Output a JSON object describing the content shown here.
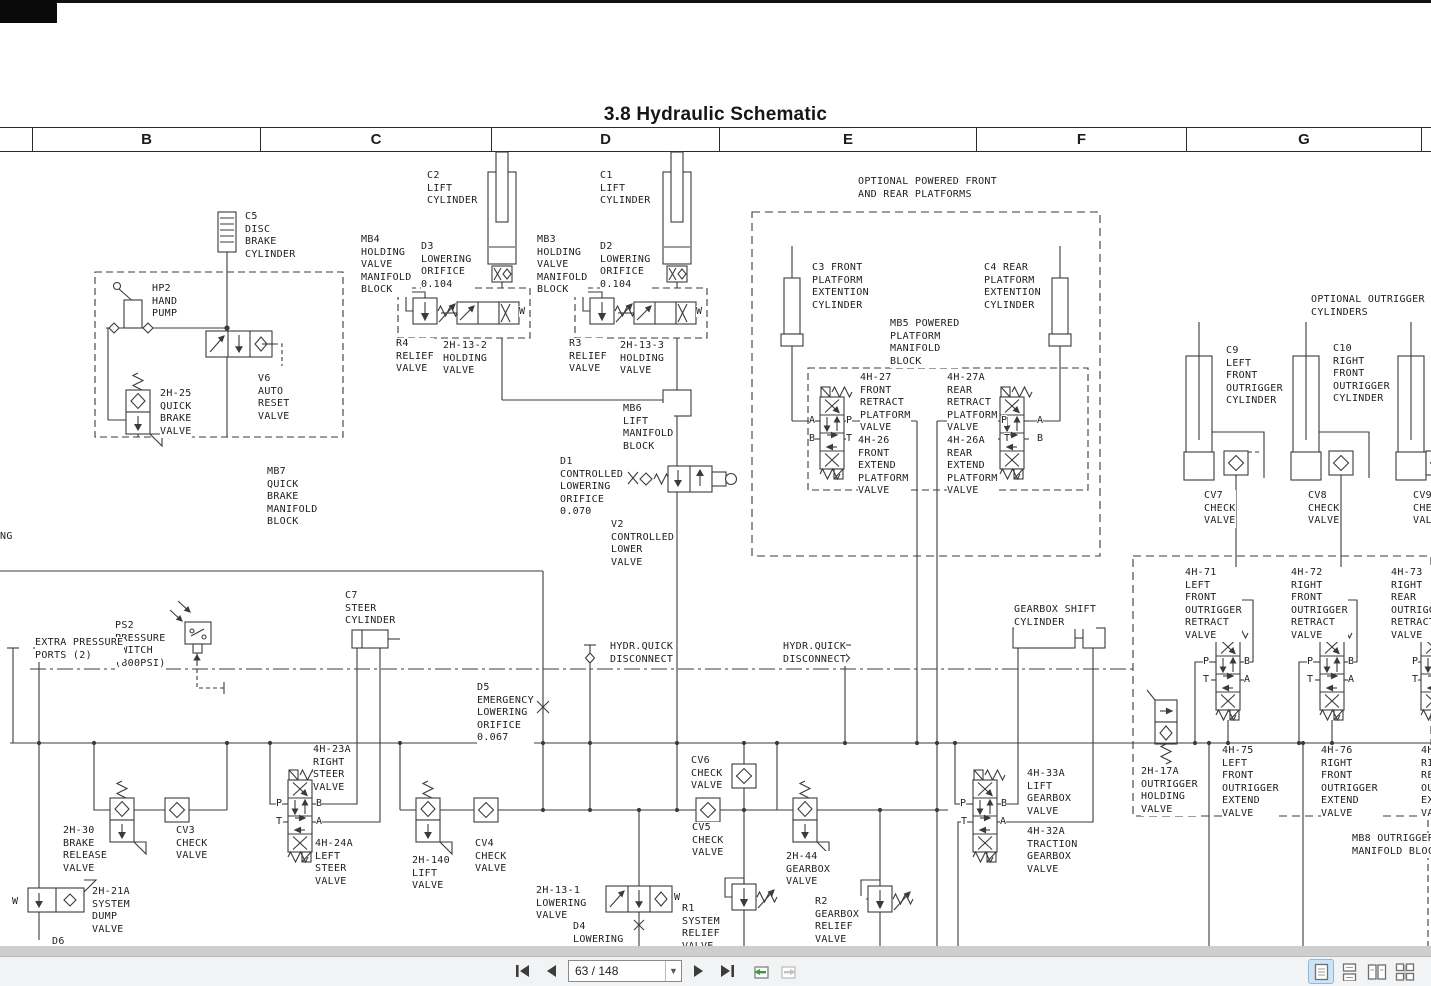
{
  "document": {
    "title": "3.8  Hydraulic Schematic",
    "grid_columns": [
      "B",
      "C",
      "D",
      "E",
      "F",
      "G"
    ],
    "page_number_shown": "63",
    "page_count_shown": "148",
    "schematic": {
      "line_color": "#3b3b3b",
      "labels": [
        {
          "text": "C5\nDISC\nBRAKE\nCYLINDER",
          "x": 245,
          "y": 211
        },
        {
          "text": "C2\nLIFT\nCYLINDER",
          "x": 427,
          "y": 170
        },
        {
          "text": "C1\nLIFT\nCYLINDER",
          "x": 600,
          "y": 170
        },
        {
          "text": "OPTIONAL POWERED FRONT\nAND REAR PLATFORMS",
          "x": 858,
          "y": 176
        },
        {
          "text": "MB4\nHOLDING\nVALVE\nMANIFOLD\nBLOCK",
          "x": 361,
          "y": 234
        },
        {
          "text": "D3\nLOWERING\nORIFICE\n0.104",
          "x": 421,
          "y": 241
        },
        {
          "text": "MB3\nHOLDING\nVALVE\nMANIFOLD\nBLOCK",
          "x": 537,
          "y": 234
        },
        {
          "text": "D2\nLOWERING\nORIFICE\n0.104",
          "x": 600,
          "y": 241
        },
        {
          "text": "HP2\nHAND\nPUMP",
          "x": 152,
          "y": 283
        },
        {
          "text": "OPTIONAL OUTRIGGER\nCYLINDERS",
          "x": 1311,
          "y": 294
        },
        {
          "text": "C3 FRONT\nPLATFORM\nEXTENTION\nCYLINDER",
          "x": 812,
          "y": 262
        },
        {
          "text": "C4 REAR\nPLATFORM\nEXTENTION\nCYLINDER",
          "x": 984,
          "y": 262
        },
        {
          "text": "MB5 POWERED\nPLATFORM\nMANIFOLD\nBLOCK",
          "x": 890,
          "y": 318
        },
        {
          "text": "R4\nRELIEF\nVALVE",
          "x": 396,
          "y": 338
        },
        {
          "text": "2H-13-2\nHOLDING\nVALVE",
          "x": 443,
          "y": 340
        },
        {
          "text": "R3\nRELIEF\nVALVE",
          "x": 569,
          "y": 338
        },
        {
          "text": "2H-13-3\nHOLDING\nVALVE",
          "x": 620,
          "y": 340
        },
        {
          "text": "C9\nLEFT\nFRONT\nOUTRIGGER\nCYLINDER",
          "x": 1226,
          "y": 345
        },
        {
          "text": "C10\nRIGHT\nFRONT\nOUTRIGGER\nCYLINDER",
          "x": 1333,
          "y": 343
        },
        {
          "text": "V6\nAUTO\nRESET\nVALVE",
          "x": 258,
          "y": 373
        },
        {
          "text": "2H-25\nQUICK\nBRAKE\nVALVE",
          "x": 160,
          "y": 388
        },
        {
          "text": "4H-27\nFRONT\nRETRACT\nPLATFORM\nVALVE",
          "x": 860,
          "y": 372
        },
        {
          "text": "4H-27A\nREAR\nRETRACT\nPLATFORM\nVALVE",
          "x": 947,
          "y": 372
        },
        {
          "text": "MB6\nLIFT\nMANIFOLD\nBLOCK",
          "x": 623,
          "y": 403
        },
        {
          "text": "4H-26\nFRONT\nEXTEND\nPLATFORM\nVALVE",
          "x": 858,
          "y": 435
        },
        {
          "text": "4H-26A\nREAR\nEXTEND\nPLATFORM\nVALVE",
          "x": 947,
          "y": 435
        },
        {
          "text": "D1\nCONTROLLED\nLOWERING\nORIFICE\n0.070",
          "x": 560,
          "y": 456
        },
        {
          "text": "MB7\nQUICK\nBRAKE\nMANIFOLD\nBLOCK",
          "x": 267,
          "y": 466
        },
        {
          "text": "CV7\nCHECK\nVALVE",
          "x": 1204,
          "y": 490
        },
        {
          "text": "CV8\nCHECK\nVALVE",
          "x": 1308,
          "y": 490
        },
        {
          "text": "CV9\nCHECK\nVALVE",
          "x": 1413,
          "y": 490
        },
        {
          "text": "V2\nCONTROLLED\nLOWER\nVALVE",
          "x": 611,
          "y": 519
        },
        {
          "text": "NG",
          "x": 0,
          "y": 531
        },
        {
          "text": "4H-71\nLEFT\nFRONT\nOUTRIGGER\nRETRACT\nVALVE",
          "x": 1185,
          "y": 567
        },
        {
          "text": "4H-72\nRIGHT\nFRONT\nOUTRIGGER\nRETRACT\nVALVE",
          "x": 1291,
          "y": 567
        },
        {
          "text": "4H-73\nRIGHT\nREAR\nOUTRIGGER\nRETRACT\nVALVE",
          "x": 1391,
          "y": 567
        },
        {
          "text": "C7\nSTEER\nCYLINDER",
          "x": 345,
          "y": 590
        },
        {
          "text": "GEARBOX SHIFT\nCYLINDER",
          "x": 1014,
          "y": 604
        },
        {
          "text": "PS2\nPRESSURE\nSWITCH\n(800PSI)",
          "x": 115,
          "y": 620
        },
        {
          "text": "EXTRA PRESSURE\nPORTS (2)",
          "x": 35,
          "y": 637
        },
        {
          "text": "HYDR.QUICK\nDISCONNECT",
          "x": 610,
          "y": 641
        },
        {
          "text": "HYDR.QUICK\nDISCONNECT",
          "x": 783,
          "y": 641
        },
        {
          "text": "D5\nEMERGENCY\nLOWERING\nORIFICE\n0.067",
          "x": 477,
          "y": 682
        },
        {
          "text": "4H-23A\nRIGHT\nSTEER\nVALVE",
          "x": 313,
          "y": 744
        },
        {
          "text": "4H-75\nLEFT\nFRONT\nOUTRIGGER\nEXTEND\nVALVE",
          "x": 1222,
          "y": 745
        },
        {
          "text": "4H-76\nRIGHT\nFRONT\nOUTRIGGER\nEXTEND\nVALVE",
          "x": 1321,
          "y": 745
        },
        {
          "text": "4H-77\nRIGHT\nREAR\nOUTRIGGER\nEXTEND\nVALVE",
          "x": 1421,
          "y": 745
        },
        {
          "text": "CV6\nCHECK\nVALVE",
          "x": 691,
          "y": 755
        },
        {
          "text": "2H-17A\nOUTRIGGER\nHOLDING\nVALVE",
          "x": 1141,
          "y": 766
        },
        {
          "text": "4H-33A\nLIFT\nGEARBOX\nVALVE",
          "x": 1027,
          "y": 768
        },
        {
          "text": "CV5\nCHECK\nVALVE",
          "x": 692,
          "y": 822
        },
        {
          "text": "2H-30\nBRAKE\nRELEASE\nVALVE",
          "x": 63,
          "y": 825
        },
        {
          "text": "CV3\nCHECK\nVALVE",
          "x": 176,
          "y": 825
        },
        {
          "text": "4H-32A\nTRACTION\nGEARBOX\nVALVE",
          "x": 1027,
          "y": 826
        },
        {
          "text": "4H-24A\nLEFT\nSTEER\nVALVE",
          "x": 315,
          "y": 838
        },
        {
          "text": "MB8 OUTRIGGER\nMANIFOLD BLOCK",
          "x": 1352,
          "y": 833
        },
        {
          "text": "2H-140\nLIFT\nVALVE",
          "x": 412,
          "y": 855
        },
        {
          "text": "CV4\nCHECK\nVALVE",
          "x": 475,
          "y": 838
        },
        {
          "text": "2H-44\nGEARBOX\nVALVE",
          "x": 786,
          "y": 851
        },
        {
          "text": "2H-21A\nSYSTEM\nDUMP\nVALVE",
          "x": 92,
          "y": 886
        },
        {
          "text": "2H-13-1\nLOWERING\nVALVE",
          "x": 536,
          "y": 885
        },
        {
          "text": "R1\nSYSTEM\nRELIEF\nVALVE",
          "x": 682,
          "y": 903
        },
        {
          "text": "R2\nGEARBOX\nRELIEF\nVALVE\n(500PSI)",
          "x": 815,
          "y": 896
        },
        {
          "text": "D4\nLOWERING",
          "x": 573,
          "y": 921
        },
        {
          "text": "D6",
          "x": 52,
          "y": 936
        }
      ],
      "ports": [
        {
          "t": "A",
          "x": 809,
          "y": 415
        },
        {
          "t": "P",
          "x": 846,
          "y": 415
        },
        {
          "t": "B",
          "x": 809,
          "y": 433
        },
        {
          "t": "T",
          "x": 846,
          "y": 433
        },
        {
          "t": "P",
          "x": 1001,
          "y": 415
        },
        {
          "t": "A",
          "x": 1037,
          "y": 415
        },
        {
          "t": "T",
          "x": 1004,
          "y": 433
        },
        {
          "t": "B",
          "x": 1037,
          "y": 433
        },
        {
          "t": "P",
          "x": 276,
          "y": 798
        },
        {
          "t": "B",
          "x": 316,
          "y": 798
        },
        {
          "t": "T",
          "x": 276,
          "y": 816
        },
        {
          "t": "A",
          "x": 316,
          "y": 816
        },
        {
          "t": "P",
          "x": 960,
          "y": 798
        },
        {
          "t": "B",
          "x": 1001,
          "y": 798
        },
        {
          "t": "T",
          "x": 961,
          "y": 816
        },
        {
          "t": "A",
          "x": 1000,
          "y": 816
        },
        {
          "t": "P",
          "x": 1203,
          "y": 656
        },
        {
          "t": "B",
          "x": 1244,
          "y": 656
        },
        {
          "t": "T",
          "x": 1203,
          "y": 674
        },
        {
          "t": "A",
          "x": 1244,
          "y": 674
        },
        {
          "t": "P",
          "x": 1307,
          "y": 656
        },
        {
          "t": "B",
          "x": 1348,
          "y": 656
        },
        {
          "t": "T",
          "x": 1307,
          "y": 674
        },
        {
          "t": "A",
          "x": 1348,
          "y": 674
        },
        {
          "t": "P",
          "x": 1412,
          "y": 656
        },
        {
          "t": "T",
          "x": 1412,
          "y": 674
        },
        {
          "t": "W",
          "x": 519,
          "y": 306
        },
        {
          "t": "W",
          "x": 696,
          "y": 306
        },
        {
          "t": "W",
          "x": 674,
          "y": 892
        },
        {
          "t": "W",
          "x": 12,
          "y": 896
        }
      ]
    }
  },
  "toolbar": {
    "page_indicator": "63 / 148",
    "buttons": {
      "first_page": "First Page",
      "previous_page": "Previous Page",
      "next_page": "Next Page",
      "last_page": "Last Page",
      "previous_view": "Previous View",
      "next_view": "Next View"
    },
    "view_modes": [
      {
        "name": "single-page",
        "active": true
      },
      {
        "name": "continuous",
        "active": false
      },
      {
        "name": "facing",
        "active": false
      },
      {
        "name": "facing-continuous",
        "active": false
      }
    ],
    "accent_color": "#cde3f7",
    "green_arrow_color": "#3d9c3d"
  }
}
